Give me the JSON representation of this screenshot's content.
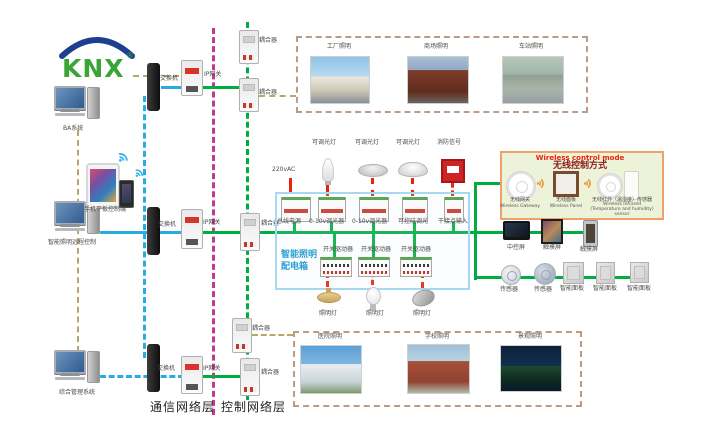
{
  "logo": {
    "text": "KNX",
    "registered": "®"
  },
  "left_column": {
    "pc_ba": "BA系统",
    "pc_remote": "智能照明远程控制",
    "pc_mgmt": "综合管理系统",
    "mobile": "手机平板控制端"
  },
  "network": {
    "switch": "交换机",
    "ip_gateway": "IP网关",
    "coupler": "耦合器",
    "comm_layer": "通信网络层",
    "ctrl_layer": "控制网络层"
  },
  "top_scenes": [
    "工厂照明",
    "商场照明",
    "车站照明"
  ],
  "bottom_scenes": [
    "医院照明",
    "学校照明",
    "景观照明"
  ],
  "panel": {
    "name_line1": "智能照明",
    "name_line2": "配电箱",
    "power_in": "220vAC",
    "dim_lamp": "可调光灯",
    "fire_signal": "消防信号",
    "devices_row1": [
      "总线电源",
      "0-10v调光器",
      "0-10v调光器",
      "可控硅调光",
      "干接点输入"
    ],
    "actuator": "开关驱动器",
    "lamp": "照明灯"
  },
  "wireless": {
    "title_en": "Wireless control mode",
    "title_cn": "无线控制方式",
    "gateway_cn": "无线网关",
    "gateway_en": "Wireless Gateway",
    "panel_cn": "无线面板",
    "panel_en": "Wireless Panel",
    "ir_cn": "无线红外（温湿度）传感器",
    "ir_en": "Wireless Infrared (Temperature and humidity) sensor"
  },
  "right_devices": {
    "central_screen": "中控屏",
    "touch_screen": "触摸屏",
    "sensor": "传感器",
    "smart_panel": "智能面板"
  },
  "colors": {
    "bus_green": "#00ad43",
    "comm_blue": "#29abe2",
    "layer_magenta": "#c23a8a",
    "link_khaki": "#b8a66a",
    "scene_dash": "#bb9a86",
    "signal_red": "#e8220d",
    "panel_border": "#a8d8ef",
    "panel_text": "#2e9fd4",
    "wireless_bg": "#edf3d8",
    "wireless_border": "#efa268"
  }
}
